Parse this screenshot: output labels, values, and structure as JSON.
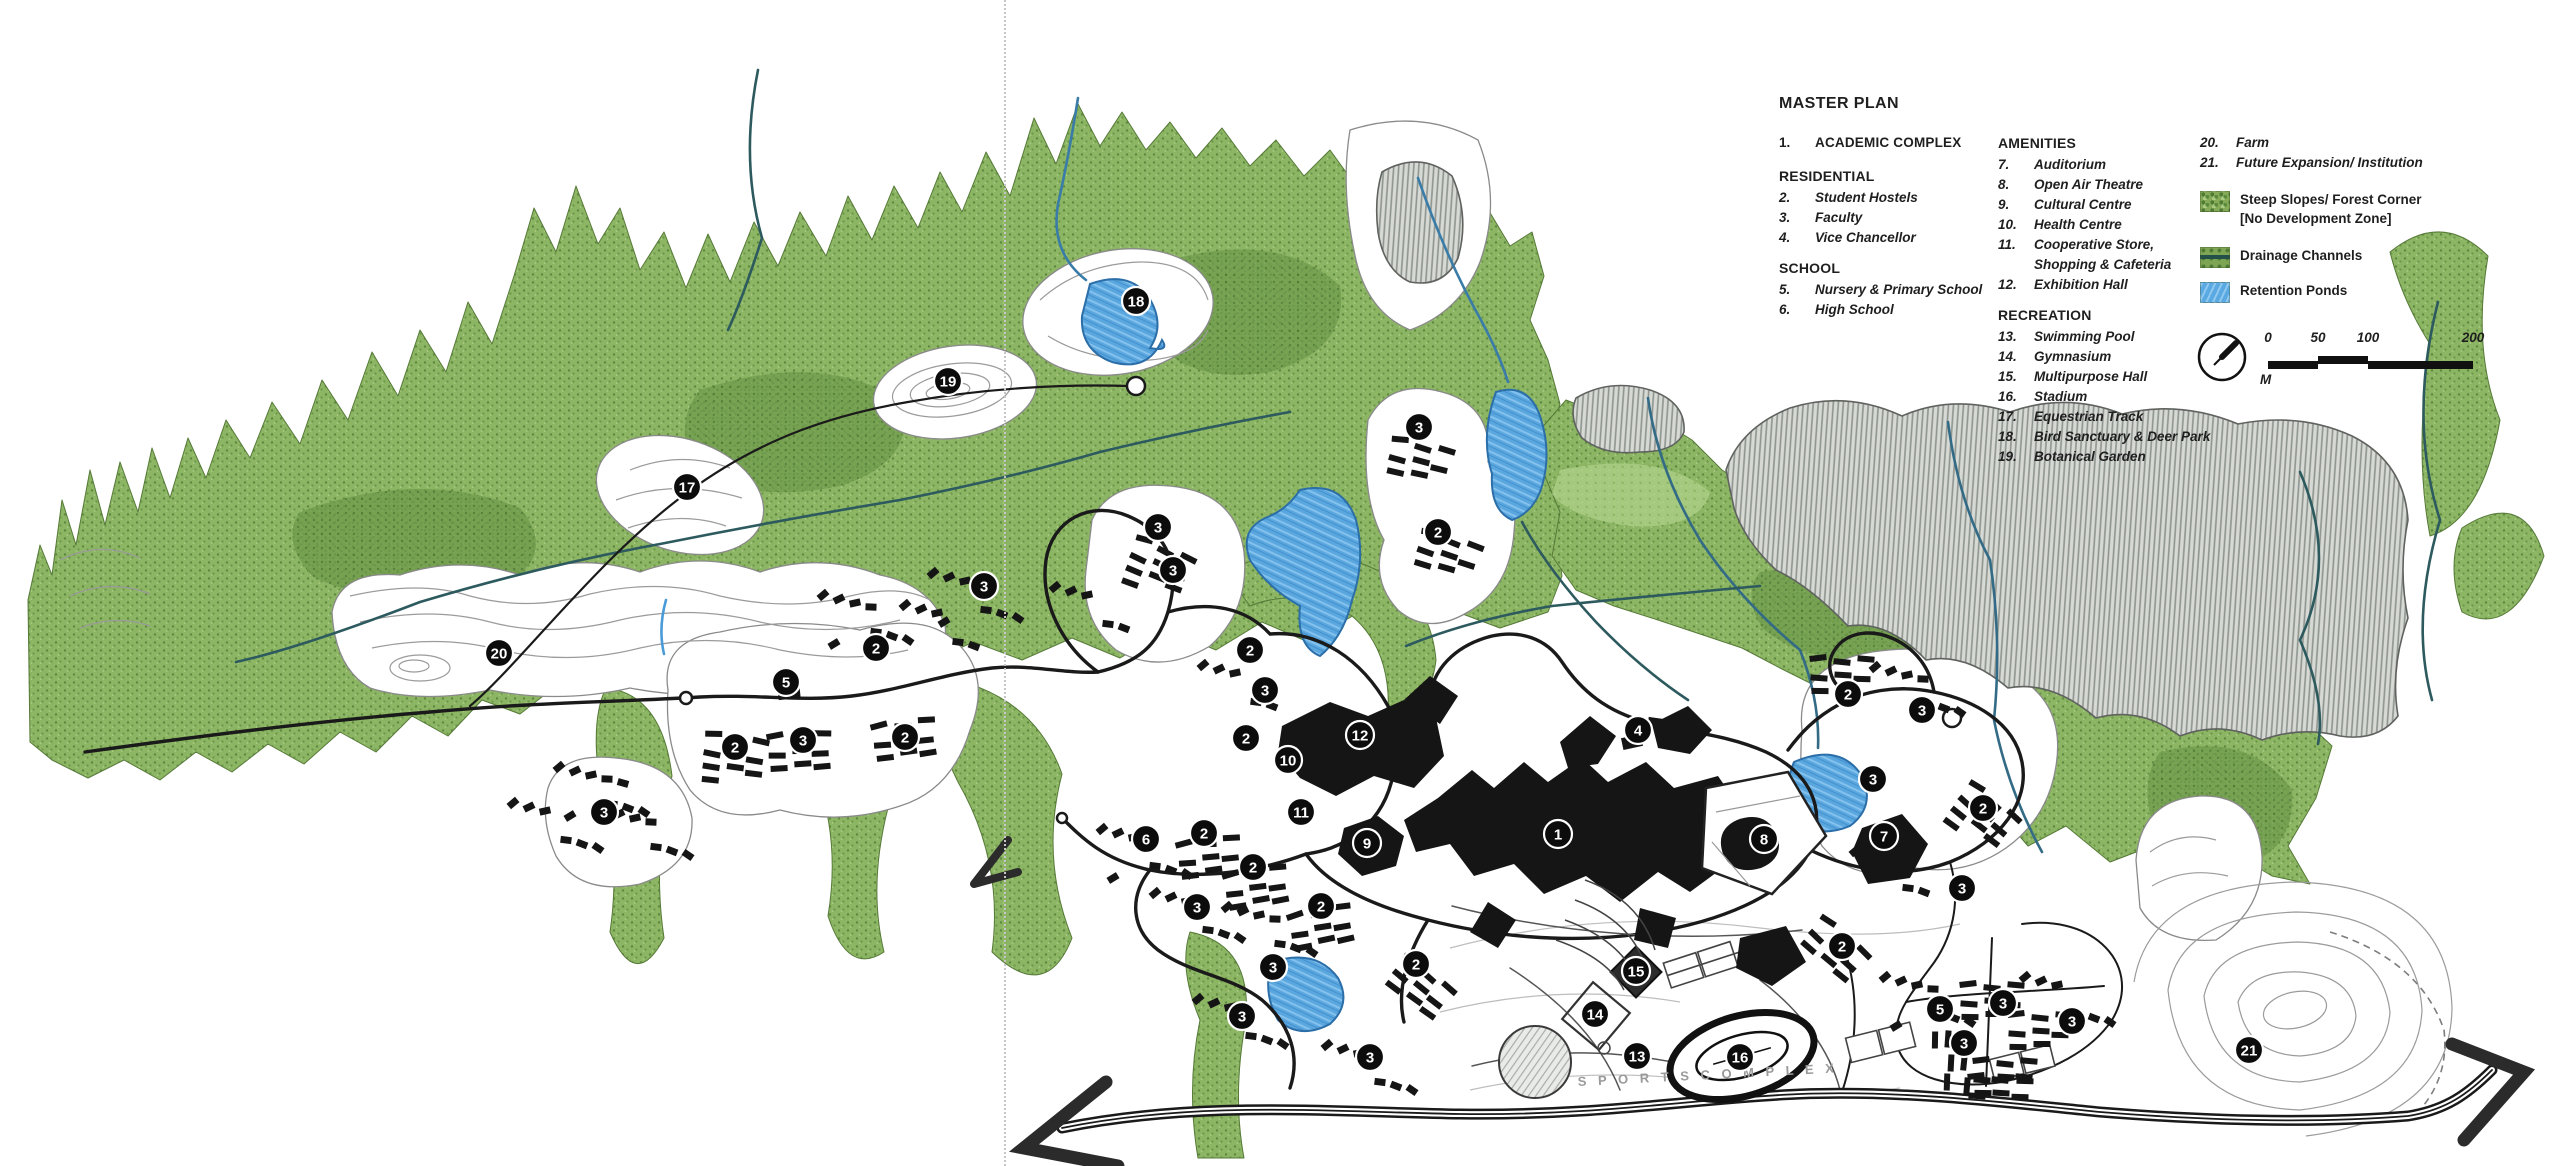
{
  "legend": {
    "title": "MASTER PLAN",
    "columns_x": [
      1779,
      1998,
      2200
    ],
    "groups": [
      {
        "col": 0,
        "top": 133,
        "header": null,
        "items": [
          {
            "num": "1.",
            "label": "ACADEMIC COMPLEX",
            "caps": true
          }
        ]
      },
      {
        "col": 0,
        "top": 166,
        "header": "RESIDENTIAL",
        "items": [
          {
            "num": "2.",
            "label": "Student Hostels"
          },
          {
            "num": "3.",
            "label": "Faculty"
          },
          {
            "num": "4.",
            "label": "Vice Chancellor"
          }
        ]
      },
      {
        "col": 0,
        "top": 258,
        "header": "SCHOOL",
        "items": [
          {
            "num": "5.",
            "label": "Nursery & Primary School"
          },
          {
            "num": "6.",
            "label": "High School"
          }
        ]
      },
      {
        "col": 1,
        "top": 133,
        "header": "AMENITIES",
        "items": [
          {
            "num": "7.",
            "label": "Auditorium"
          },
          {
            "num": "8.",
            "label": "Open Air Theatre"
          },
          {
            "num": "9.",
            "label": "Cultural Centre"
          },
          {
            "num": "10.",
            "label": "Health Centre"
          },
          {
            "num": "11.",
            "label": "Cooperative Store,",
            "label2": "Shopping & Cafeteria"
          },
          {
            "num": "12.",
            "label": "Exhibition Hall"
          }
        ]
      },
      {
        "col": 1,
        "top": 305,
        "header": "RECREATION",
        "items": [
          {
            "num": "13.",
            "label": "Swimming Pool"
          },
          {
            "num": "14.",
            "label": "Gymnasium"
          },
          {
            "num": "15.",
            "label": "Multipurpose Hall"
          },
          {
            "num": "16.",
            "label": "Stadium"
          },
          {
            "num": "17.",
            "label": "Equestrian Track"
          },
          {
            "num": "18.",
            "label": "Bird Sanctuary & Deer Park"
          },
          {
            "num": "19.",
            "label": "Botanical Garden"
          }
        ]
      },
      {
        "col": 2,
        "top": 133,
        "header": null,
        "items": [
          {
            "num": "20.",
            "label": "Farm"
          },
          {
            "num": "21.",
            "label": "Future Expansion/ Institution"
          }
        ]
      }
    ],
    "swatches": [
      {
        "top": 190,
        "kind": "forest",
        "label": "Steep Slopes/ Forest Corner",
        "label2": "[No Development Zone]"
      },
      {
        "top": 246,
        "kind": "drainage",
        "label": "Drainage Channels",
        "label2": ""
      },
      {
        "top": 281,
        "kind": "pond",
        "label": "Retention Ponds",
        "label2": ""
      }
    ]
  },
  "scalebar": {
    "ticks": [
      "0",
      "50",
      "100",
      "200"
    ],
    "tick_x": [
      10,
      60,
      110,
      215
    ],
    "segments": [
      [
        10,
        50,
        5
      ],
      [
        60,
        50,
        0
      ],
      [
        110,
        105,
        5
      ]
    ],
    "unit": "M"
  },
  "map": {
    "sports_label": "S P O R T S   C O M P L E X",
    "markers": [
      {
        "n": "1",
        "x": 1558,
        "y": 834
      },
      {
        "n": "2",
        "x": 876,
        "y": 648
      },
      {
        "n": "2",
        "x": 735,
        "y": 747
      },
      {
        "n": "2",
        "x": 905,
        "y": 737
      },
      {
        "n": "2",
        "x": 1250,
        "y": 650
      },
      {
        "n": "2",
        "x": 1246,
        "y": 738
      },
      {
        "n": "2",
        "x": 1438,
        "y": 532
      },
      {
        "n": "2",
        "x": 1848,
        "y": 694
      },
      {
        "n": "2",
        "x": 1983,
        "y": 808
      },
      {
        "n": "2",
        "x": 1204,
        "y": 833
      },
      {
        "n": "2",
        "x": 1253,
        "y": 867
      },
      {
        "n": "2",
        "x": 1321,
        "y": 906
      },
      {
        "n": "2",
        "x": 1416,
        "y": 964
      },
      {
        "n": "2",
        "x": 1842,
        "y": 946
      },
      {
        "n": "3",
        "x": 1419,
        "y": 427
      },
      {
        "n": "3",
        "x": 1158,
        "y": 527
      },
      {
        "n": "3",
        "x": 1173,
        "y": 570
      },
      {
        "n": "3",
        "x": 984,
        "y": 586
      },
      {
        "n": "3",
        "x": 803,
        "y": 740
      },
      {
        "n": "3",
        "x": 604,
        "y": 812
      },
      {
        "n": "3",
        "x": 1265,
        "y": 690
      },
      {
        "n": "3",
        "x": 1922,
        "y": 710
      },
      {
        "n": "3",
        "x": 1873,
        "y": 779
      },
      {
        "n": "3",
        "x": 1962,
        "y": 888
      },
      {
        "n": "3",
        "x": 1197,
        "y": 907
      },
      {
        "n": "3",
        "x": 1273,
        "y": 967
      },
      {
        "n": "3",
        "x": 1242,
        "y": 1016
      },
      {
        "n": "3",
        "x": 1370,
        "y": 1057
      },
      {
        "n": "3",
        "x": 2003,
        "y": 1003
      },
      {
        "n": "3",
        "x": 1964,
        "y": 1043
      },
      {
        "n": "3",
        "x": 2072,
        "y": 1021
      },
      {
        "n": "4",
        "x": 1638,
        "y": 730
      },
      {
        "n": "5",
        "x": 786,
        "y": 682
      },
      {
        "n": "5",
        "x": 1940,
        "y": 1009
      },
      {
        "n": "6",
        "x": 1146,
        "y": 839
      },
      {
        "n": "7",
        "x": 1884,
        "y": 836
      },
      {
        "n": "8",
        "x": 1764,
        "y": 839
      },
      {
        "n": "9",
        "x": 1367,
        "y": 843
      },
      {
        "n": "10",
        "x": 1288,
        "y": 760
      },
      {
        "n": "11",
        "x": 1301,
        "y": 812
      },
      {
        "n": "12",
        "x": 1360,
        "y": 735
      },
      {
        "n": "13",
        "x": 1637,
        "y": 1056
      },
      {
        "n": "14",
        "x": 1595,
        "y": 1014
      },
      {
        "n": "15",
        "x": 1636,
        "y": 971
      },
      {
        "n": "16",
        "x": 1740,
        "y": 1057
      },
      {
        "n": "17",
        "x": 687,
        "y": 487
      },
      {
        "n": "18",
        "x": 1136,
        "y": 301
      },
      {
        "n": "19",
        "x": 948,
        "y": 381
      },
      {
        "n": "20",
        "x": 499,
        "y": 653
      },
      {
        "n": "21",
        "x": 2249,
        "y": 1050
      }
    ]
  },
  "colors": {
    "forest_green": "#8cb564",
    "forest_dark": "#6d9a4a",
    "forest_light": "#a9cc82",
    "pond_blue": "#5aa7e0",
    "pond_edge": "#2b6ea8",
    "drainage_teal": "#2d5a5e",
    "road_black": "#1a1a1a",
    "building_black": "#151515",
    "hatch_gray": "#8e948f",
    "contour_gray": "#9b9b9b",
    "marker_black": "#0c0c0c",
    "marker_text": "#ffffff"
  }
}
